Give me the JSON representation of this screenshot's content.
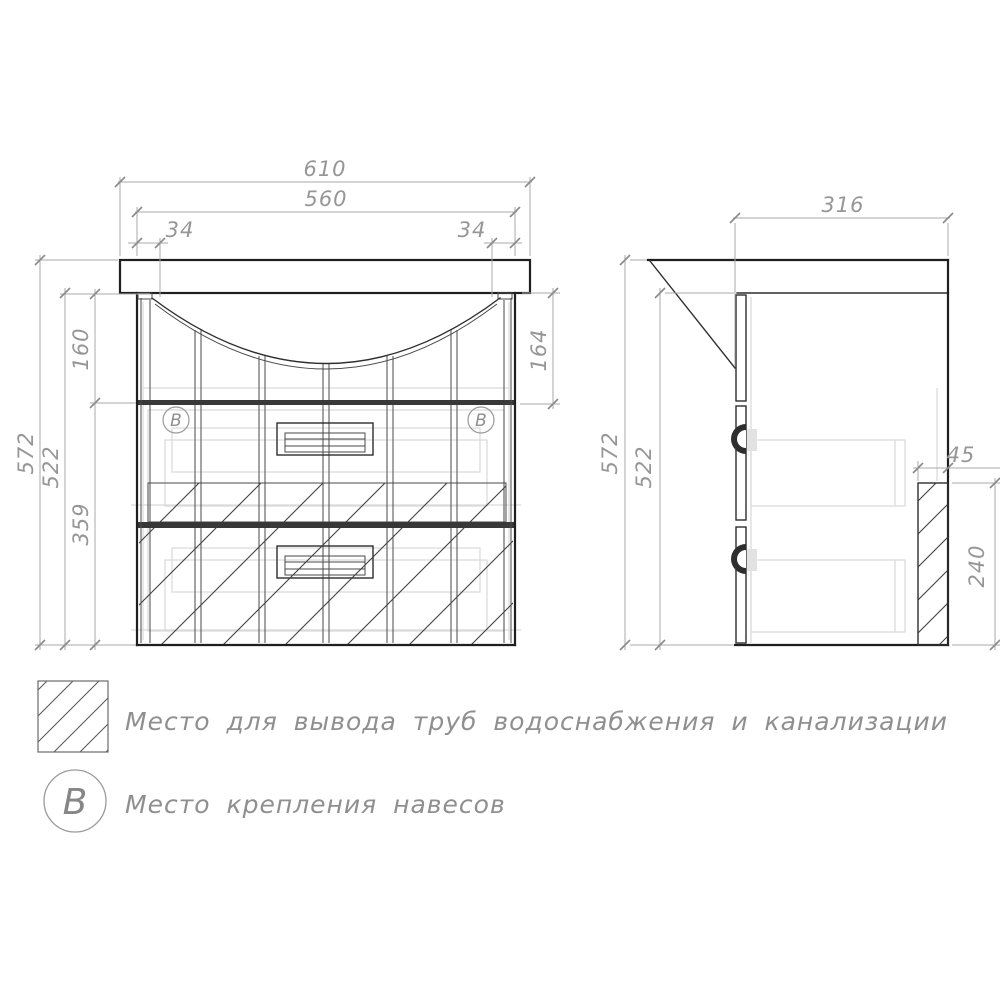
{
  "front_view": {
    "dim_total_width": "610",
    "dim_cabinet_width": "560",
    "dim_offset_left": "34",
    "dim_offset_right": "34",
    "dim_total_height": "572",
    "dim_cabinet_height": "522",
    "dim_apron_height": "160",
    "dim_drawers_height": "359",
    "dim_basin_depth": "164",
    "marker_letter": "В"
  },
  "side_view": {
    "dim_depth": "316",
    "dim_total_height": "572",
    "dim_cabinet_height": "522",
    "dim_pipe_zone_width": "45",
    "dim_pipe_zone_height": "240"
  },
  "legend": {
    "pipe_zone_label": "Место для вывода труб водоснабжения и канализации",
    "mount_marker_letter": "В",
    "mount_label": "Место крепления навесов"
  },
  "colors": {
    "outline": "#1f1f1f",
    "dimension": "#a8a8a8",
    "dimension_text": "#969696",
    "hatch": "#3f3f3f",
    "internal_gray": "#d9d9d9",
    "background": "#ffffff"
  }
}
